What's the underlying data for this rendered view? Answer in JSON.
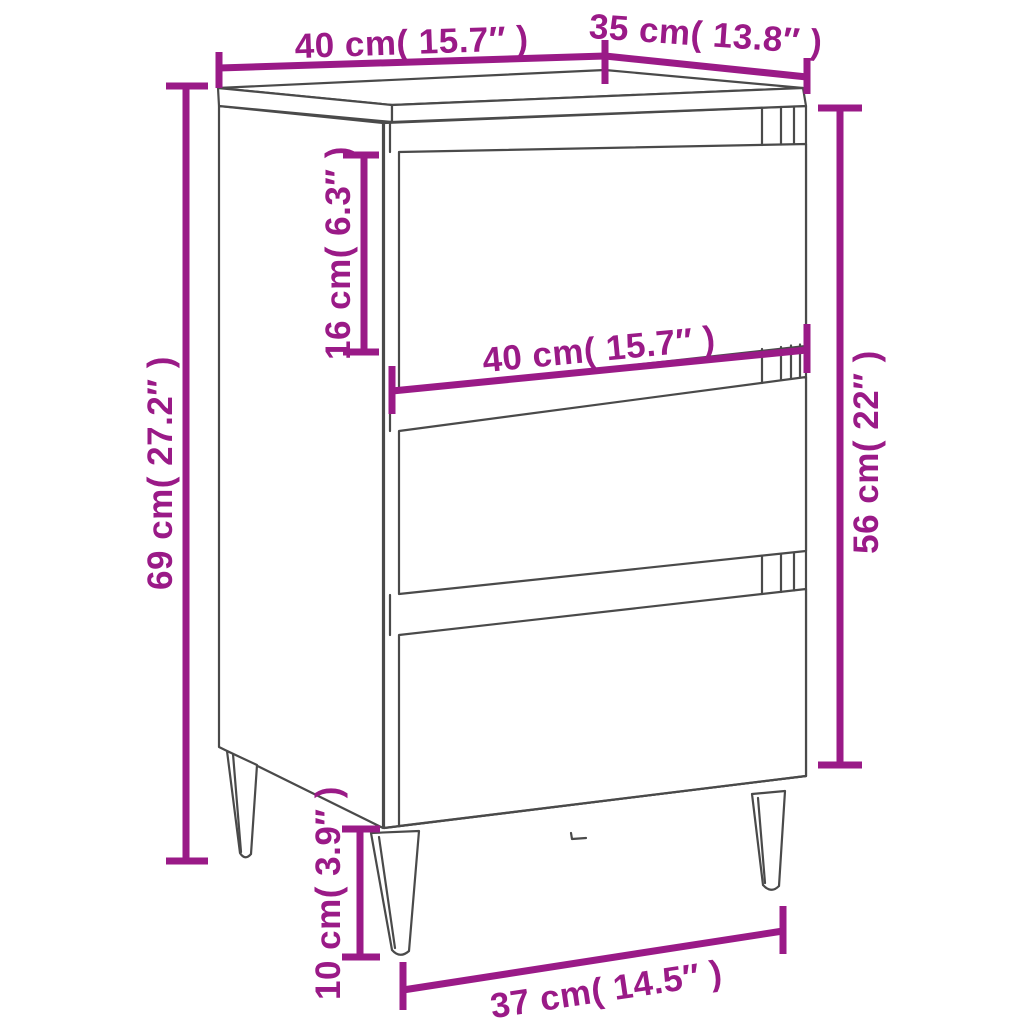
{
  "diagram": {
    "figure": "bedside-cabinet-three-drawers-metal-legs",
    "type": "product-dimension-diagram",
    "background_color": "#ffffff",
    "outline_color": "#4a4a4a",
    "dimension_color": "#9a1a87",
    "dims": {
      "top_width": {
        "label": "40 cm( 15.7″ )",
        "value_cm": 40,
        "value_in": 15.7
      },
      "top_depth": {
        "label": "35 cm( 13.8″ )",
        "value_cm": 35,
        "value_in": 13.8
      },
      "overall_height": {
        "label": "69 cm( 27.2″ )",
        "value_cm": 69,
        "value_in": 27.2
      },
      "top_drawer_height": {
        "label": "16 cm( 6.3″ )",
        "value_cm": 16,
        "value_in": 6.3
      },
      "drawer_width": {
        "label": "40 cm( 15.7″ )",
        "value_cm": 40,
        "value_in": 15.7
      },
      "body_height": {
        "label": "56 cm( 22″ )",
        "value_cm": 56,
        "value_in": 22
      },
      "leg_height": {
        "label": "10 cm( 3.9″ )",
        "value_cm": 10,
        "value_in": 3.9
      },
      "leg_span": {
        "label": "37 cm( 14.5″ )",
        "value_cm": 37,
        "value_in": 14.5
      }
    }
  }
}
